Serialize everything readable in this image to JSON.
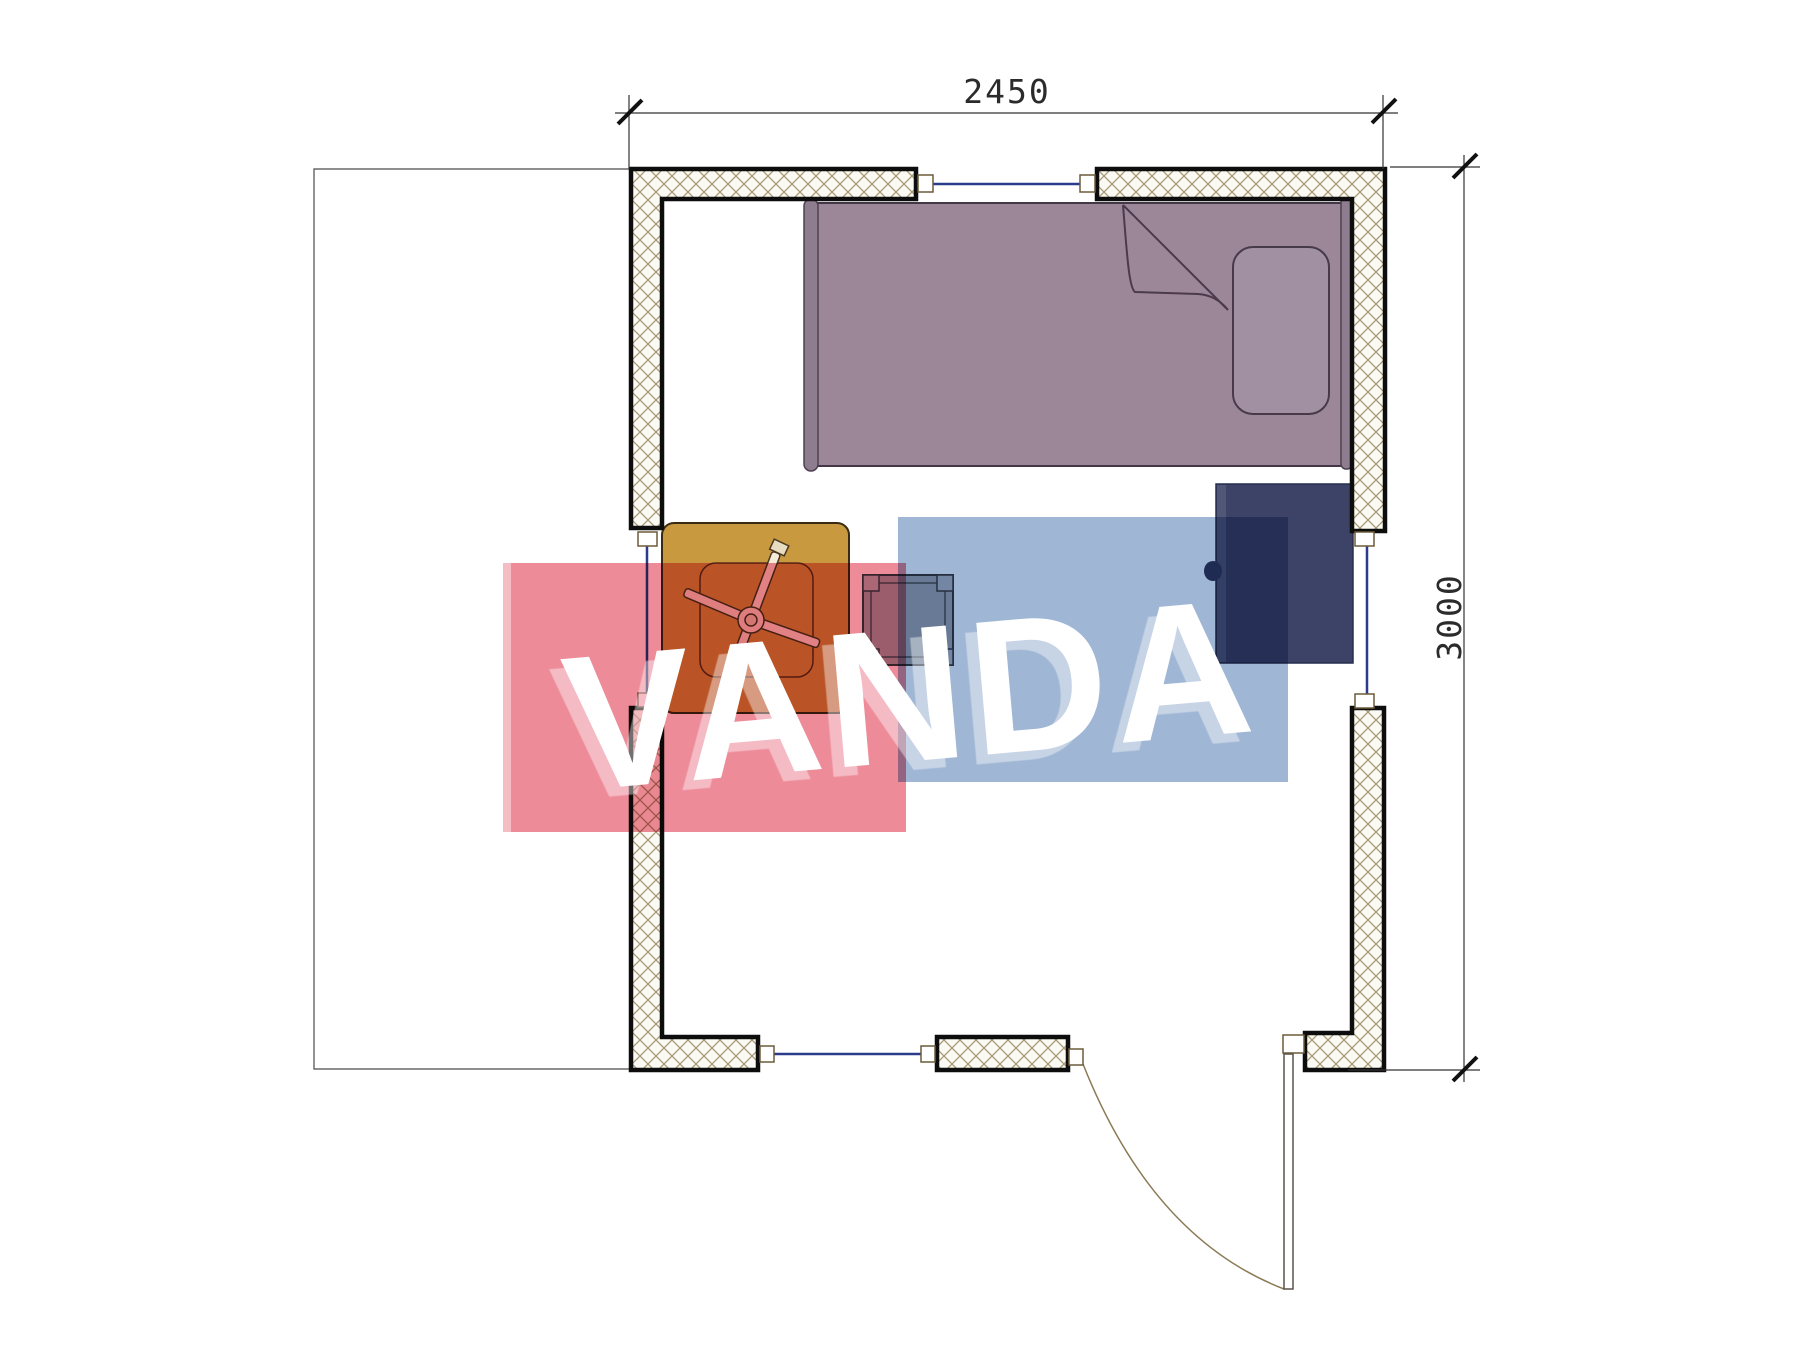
{
  "page": {
    "background": "#ffffff"
  },
  "drawing": {
    "type": "floor-plan",
    "dimension_width_label": "2450",
    "dimension_height_label": "3000",
    "furniture": [
      "single-bed",
      "pillow",
      "blanket-fold",
      "bedside-cabinet",
      "table",
      "fan",
      "stool",
      "door-leaf"
    ],
    "openings": {
      "windows": 4,
      "doors": 1
    },
    "colors": {
      "wall_hatch": "#a59a74",
      "wall_outline": "#0d0d0d",
      "window_glass": "#2c3c8c",
      "bed_fill": "#9c8798",
      "bed_outline": "#433747",
      "cabinet_fill": "#3c4367",
      "table_fill": "#c8993f",
      "door_arc": "#8a7a55",
      "dimension_line": "#333333"
    }
  },
  "watermark": {
    "text": "VANDA",
    "text_color": "#ffffff",
    "red_rect_color": "#ee8b99",
    "blue_rect_color": "#9fb6d5"
  }
}
